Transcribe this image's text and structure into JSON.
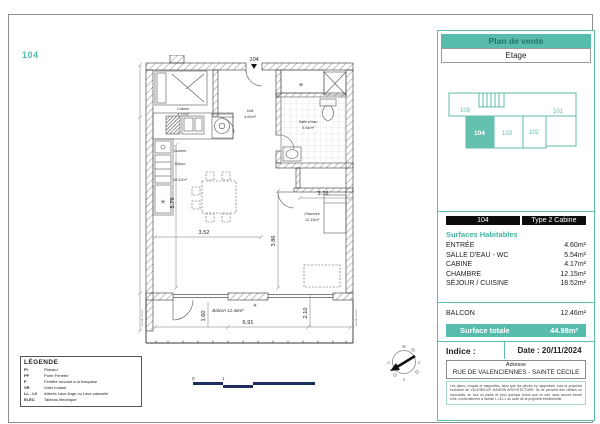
{
  "page": {
    "unit_label": "104"
  },
  "colors": {
    "teal": "#57bcab",
    "navy": "#1c2d5e",
    "header_black": "#0c0c0c"
  },
  "panel": {
    "title": "Plan de vente",
    "floor": "Etage",
    "key_plan": {
      "u105": "105",
      "u101": "101",
      "u104": "104",
      "u103": "103",
      "u102": "102"
    },
    "table": {
      "unit": "104",
      "type": "Type 2 Cabine",
      "section_title": "Surfaces Habitables",
      "rows": [
        {
          "label": "ENTRÉE",
          "value": "4.60m²"
        },
        {
          "label": "SALLE D'EAU - WC",
          "value": "5.54m²"
        },
        {
          "label": "CABINE",
          "value": "4.17m²"
        },
        {
          "label": "CHAMBRE",
          "value": "12.15m²"
        },
        {
          "label": "SÉJOUR / CUISINE",
          "value": "18.52m²"
        }
      ]
    },
    "balcon": {
      "label": "BALCON",
      "value": "12.46m²"
    },
    "total": {
      "label": "Surface totale",
      "value": "44.98m²"
    },
    "meta": {
      "indice": "Indice :",
      "date": "Date : 20/11/2024",
      "adresse_title": "Adresse",
      "adresse": "RUE DE VALENCIENNES - SAINTE CECILE",
      "legal": "Les plans, croquis et maquettes, ainsi que les pièces s'y rapportant, sont la propriété exclusive de VILLENEUVE MAISON ARCHITECTURE. Ils ne peuvent être utilisés ou reproduits, en tout ou partie et sous quelque forme que ce soit, sans accord formel écrit, conformément à l'article L.111-1 du code de la propriété intellectuelle."
    }
  },
  "legend": {
    "title": "LÉGENDE",
    "items": [
      {
        "abbr": "Pl",
        "label": "Placard"
      },
      {
        "abbr": "PF",
        "label": "Porte Fenêtre"
      },
      {
        "abbr": "F",
        "label": "Fenêtre ouvrant à la française"
      },
      {
        "abbr": "VR",
        "label": "Volet roulant"
      },
      {
        "abbr": "LL - LV",
        "label": "Attente Lave-linge ou Lave-vaisselle"
      },
      {
        "abbr": "ELEC",
        "label": "Tableau électrique"
      }
    ]
  },
  "plan": {
    "entry": "104",
    "rooms": {
      "cabine": "Cabine",
      "cabine_area": "4.17m²",
      "hall": "Hall",
      "hall_area": "4.60m²",
      "bain": "Salle d'eau",
      "bain_area": "5.54m²",
      "chambre": "Chambre",
      "chambre_area": "12.15m²",
      "cuisine": "Cuisine",
      "sejour": "Séjour",
      "sejour_area": "18.52m²",
      "balcon": "Balcon 12.46m²",
      "garde_corps": "Garde corps"
    },
    "dims": {
      "w352": "3.52",
      "h579": "5.79",
      "h386": "3.86",
      "w316": "3.16",
      "w691": "6.91",
      "h160": "1.60",
      "h210": "2.10"
    },
    "symbols": {
      "radiator": "✳"
    },
    "scale": {
      "zero": "0",
      "one": "1"
    },
    "compass": {
      "n": "N",
      "e": "E",
      "s": "S",
      "o": "O"
    }
  }
}
